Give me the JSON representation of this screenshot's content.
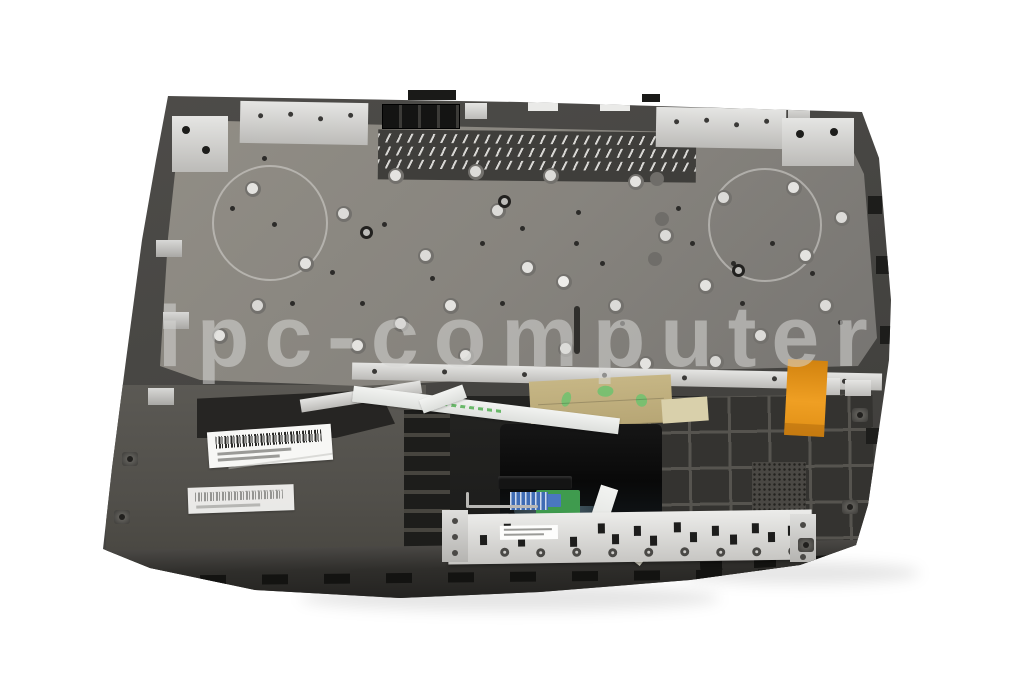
{
  "scene": {
    "type": "product-photo",
    "subject": "Laptop topcase palmrest assembly, inside view",
    "background_color": "#ffffff"
  },
  "watermark": {
    "text": "ipc-computer",
    "color": "#d7d7d5"
  },
  "colors": {
    "chassis_dark": "#47463f",
    "keyboard_backplate": "#87847e",
    "front_lip": "#2a2927",
    "metal_brackets": "#c9c8c5",
    "touchpad_glass": "#0c0c0c",
    "adhesive_tape": "#bfae7c",
    "tape_marking_green": "#6fc26f",
    "flex_cable_orange": "#e6991f",
    "ribbon_cable_white": "#ecedeb",
    "daughterboard_pcb_green": "#3f9b4e",
    "connector_blue": "#4a77c0",
    "barcode_sticker": "#f7f7f5",
    "button_board_silver": "#dcdcda"
  },
  "components": [
    "keyboard-backplate",
    "speaker-circle-left",
    "speaker-circle-right",
    "cooling-vent-slots",
    "hinge-bracket-left",
    "hinge-bracket-right",
    "metal-mounting-rail",
    "touchpad-assembly",
    "touchpad-button-board",
    "keyboard-ribbon-cable",
    "touchpad-ribbon-cable",
    "orange-flex-cable",
    "adhesive-tape",
    "barcode-sticker-top",
    "barcode-sticker-bottom",
    "reinforcement-rib-grid",
    "screw-domes",
    "front-edge-clips"
  ]
}
